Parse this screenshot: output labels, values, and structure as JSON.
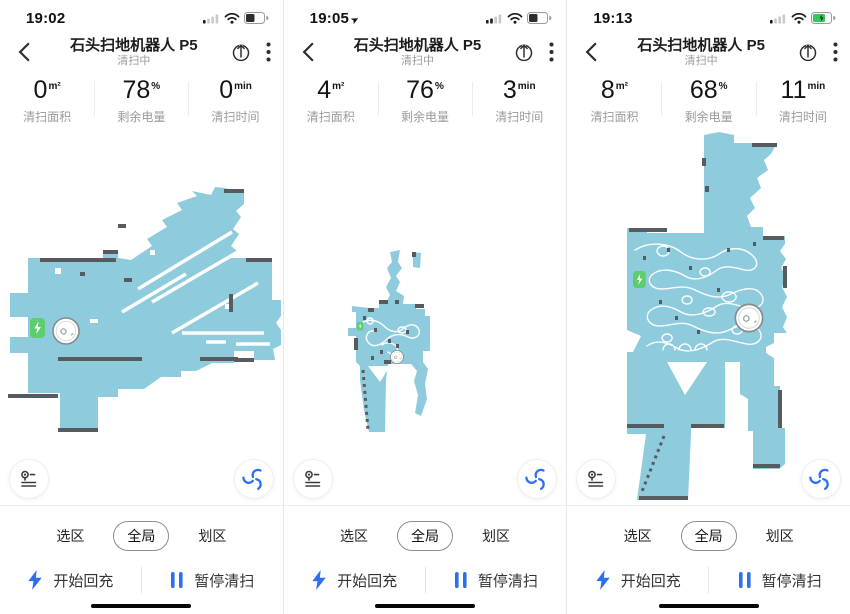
{
  "colors": {
    "accent": "#2e6ff2",
    "map_fill": "#8ecbdd",
    "wall": "#565b5f",
    "dock_green": "#5ecd70",
    "trail": "#ffffff"
  },
  "header": {
    "title": "石头扫地机器人 P5",
    "subtitle": "清扫中"
  },
  "controls": {
    "tabs": {
      "select_zone": "选区",
      "global": "全局",
      "draw_zone": "划区"
    },
    "recharge": "开始回充",
    "pause": "暂停清扫"
  },
  "panels": [
    {
      "time": "19:02",
      "loc_char": "",
      "signal_class": "sig sig-1",
      "batt_class": "batt-fill lvl45",
      "bolt_class": "bolt",
      "stats": [
        {
          "value": "0",
          "unit": "m²",
          "label": "清扫面积"
        },
        {
          "value": "78",
          "unit": "%",
          "label": "剩余电量"
        },
        {
          "value": "0",
          "unit": "min",
          "label": "清扫时间"
        }
      ],
      "map": {
        "outline": "M225,188 L244,193 L244,204 L236,211 L241,217 L233,229 L239,234 L231,246 L237,251 L231,258 L246,258 L246,262 L272,262 L272,300 L281,300 L281,316 L276,323 L281,330 L281,345 L273,349 L275,360 L254,360 L254,351 L234,351 L234,363 L212,363 L196,371 L181,371 L181,377 L161,377 L144,389 L118,389 L118,397 L98,397 L98,428 L60,428 L60,393 L28,393 L28,353 L10,353 L10,337 L28,337 L28,317 L10,317 L10,293 L28,293 L28,262 L28,258 L103,258 L103,250 L118,250 L118,258 L131,260 L152,246 L147,239 L167,227 L162,220 L182,210 L177,203 L197,196 L192,191 L211,195 L215,187 Z",
        "holes": "M55,268 h6 v6 h-6 Z M150,250 h5 v5 h-5 Z M225,304 h6 v5 h-6 Z M90,319 h8 v4 h-8 Z",
        "streaks": "M138,289 L232,232 M152,302 L248,246 M122,312 L186,274 M172,333 L258,283 M182,333 H264 M206,342 H226 M236,344 H270",
        "trails": "",
        "walls": "M40,260 H116 M103,252 H118 M224,191 H244 M8,396 H58 M58,430 H98 M58,359 H142 M200,359 H238 M231,294 V312 M234,360 H254 M246,260 H272 M124,280 H132 M80,274 H85 M118,226 H126",
        "walls_dashed": "",
        "dock_t": "translate(30,318) scale(1)",
        "robot_t": "translate(66,331) scale(1)"
      }
    },
    {
      "time": "19:05",
      "loc_char": "➤",
      "signal_class": "sig sig-2",
      "batt_class": "batt-fill lvl45",
      "bolt_class": "bolt",
      "stats": [
        {
          "value": "4",
          "unit": "m²",
          "label": "清扫面积"
        },
        {
          "value": "76",
          "unit": "%",
          "label": "剩余电量"
        },
        {
          "value": "3",
          "unit": "min",
          "label": "清扫时间"
        }
      ],
      "map": {
        "outline": "M106,252 L116,250 L114,262 L118,268 L112,276 L116,282 L112,291 L120,296 L119,304 L132,304 L132,309 L141,309 L141,316 L146,316 L146,351 L139,351 L139,362 L144,369 L141,384 L143,399 L137,416 L131,413 L134,395 L130,381 L133,371 L127,364 L104,364 L102,380 L101,432 L85,432 L80,410 L76,380 L76,366 L72,362 L72,336 L64,336 L64,328 L72,328 L72,312 L68,312 L68,306 L85,308 L95,308 L95,303 L102,303 L106,295 L102,287 L107,278 L103,268 L108,262 Z M129,252 L137,253 L136,268 L129,267 Z",
        "holes": "M84,366 L106,366 L96,382 Z",
        "streaks": "",
        "trails": "M76,324 C84,318 94,320 100,326 C106,332 114,334 120,328 C126,323 133,324 135,330 C137,336 130,340 124,337 C116,333 108,334 102,340 C96,346 88,348 84,342 C80,337 84,330 90,331 M98,345 C103,341 111,343 113,348 C115,353 108,356 104,352 M118,333 a4,3 0 1,1 0.2,0 M86,318 a3,3 0 1,0 0.2,0",
        "walls": "M95,302 H104 M131,306 H140 M72,338 V350 M100,362 H107 M130,252 V257 M84,310 H90 M113,300 V304 M90,330 h3 M104,341 h3 M96,352 h3 M87,358 h3 M112,346 h3 M122,332 h3 M79,318 h3",
        "walls_dashed": "M79,370 L84,430",
        "dock_t": "translate(73,322) scale(0.42)",
        "robot_t": "translate(113,357) scale(0.5)"
      }
    },
    {
      "time": "19:13",
      "loc_char": "",
      "signal_class": "sig sig-1",
      "batt_class": "batt-fill lvl65 chg",
      "bolt_class": "bolt show",
      "stats": [
        {
          "value": "8",
          "unit": "m²",
          "label": "清扫面积"
        },
        {
          "value": "68",
          "unit": "%",
          "label": "剩余电量"
        },
        {
          "value": "11",
          "unit": "min",
          "label": "清扫时间"
        }
      ],
      "map": {
        "outline": "M137,135 L152,132 L167,135 L167,143 L210,143 L204,154 L197,160 L201,170 L190,178 L194,188 L183,198 L188,208 L180,216 L184,227 L196,227 L196,236 L218,236 L218,244 L213,251 L219,259 L214,268 L220,277 L215,287 L220,297 L215,307 L220,317 L216,327 L220,333 L207,333 L207,343 L199,347 L199,353 L207,358 L207,386 L213,386 L213,428 L218,428 L218,464 L212,469 L186,469 L186,431 L181,431 L181,399 L173,394 L173,362 L158,362 L158,428 L124,428 L124,434 L121,500 L70,500 L79,434 L60,434 L60,228 L80,228 L80,233 L137,233 Z",
        "holes": "M100,362 L140,362 L118,395 Z M60,330 L74,336 L66,352 L60,352 Z",
        "streaks": "",
        "trails": "M68,250 C84,240 104,244 114,252 C124,260 140,262 152,254 C162,247 176,246 186,256 C194,264 188,272 178,270 C168,268 158,264 150,270 C140,278 128,282 118,276 C106,269 94,268 86,274 C78,280 84,289 94,289 C106,289 116,284 128,290 C140,296 152,300 164,294 C176,288 188,286 194,294 C200,302 192,310 182,308 C170,306 160,300 150,306 C138,314 124,318 114,312 C102,305 92,304 84,310 C76,316 82,326 92,326 C104,326 114,320 126,326 C138,332 150,336 162,330 C174,324 186,322 192,330 C198,338 190,346 180,344 C168,342 156,336 146,342 C134,350 120,354 110,348 C98,341 88,340 80,346 M96,256 a6,5 0 1,1 0.2,0 M138,268 a5,4 0 1,0 0.2,0 M162,302 a7,5 0 1,1 0.2,0 M120,296 a5,4 0 1,0 0.2,0 M142,316 a6,4 0 1,1 0.2,0 M100,334 a5,4 0 1,0 0.2,0 M170,334 a5,4 0 1,1 0.2,0 M96,350 a6,6 0 0,1 12,0 M112,350 a6,6 0 0,1 12,0 M128,350 a6,6 0 0,1 12,0",
        "walls": "M185,145 H210 M62,230 H100 M196,238 H217 M218,266 V288 M213,390 V428 M60,426 H97 M124,426 H157 M186,466 H213 M72,498 H121 M137,158 V166 M140,186 V192 M100,250 h3 M122,268 h3 M150,290 h3 M172,312 h3 M92,302 h3 M130,332 h3 M160,250 h3 M108,318 h3 M76,258 h3 M186,244 h3",
        "walls_dashed": "M97,436 L74,494",
        "dock_t": "translate(66,271) scale(0.85)",
        "robot_t": "translate(182,318) scale(1.05)"
      }
    }
  ]
}
